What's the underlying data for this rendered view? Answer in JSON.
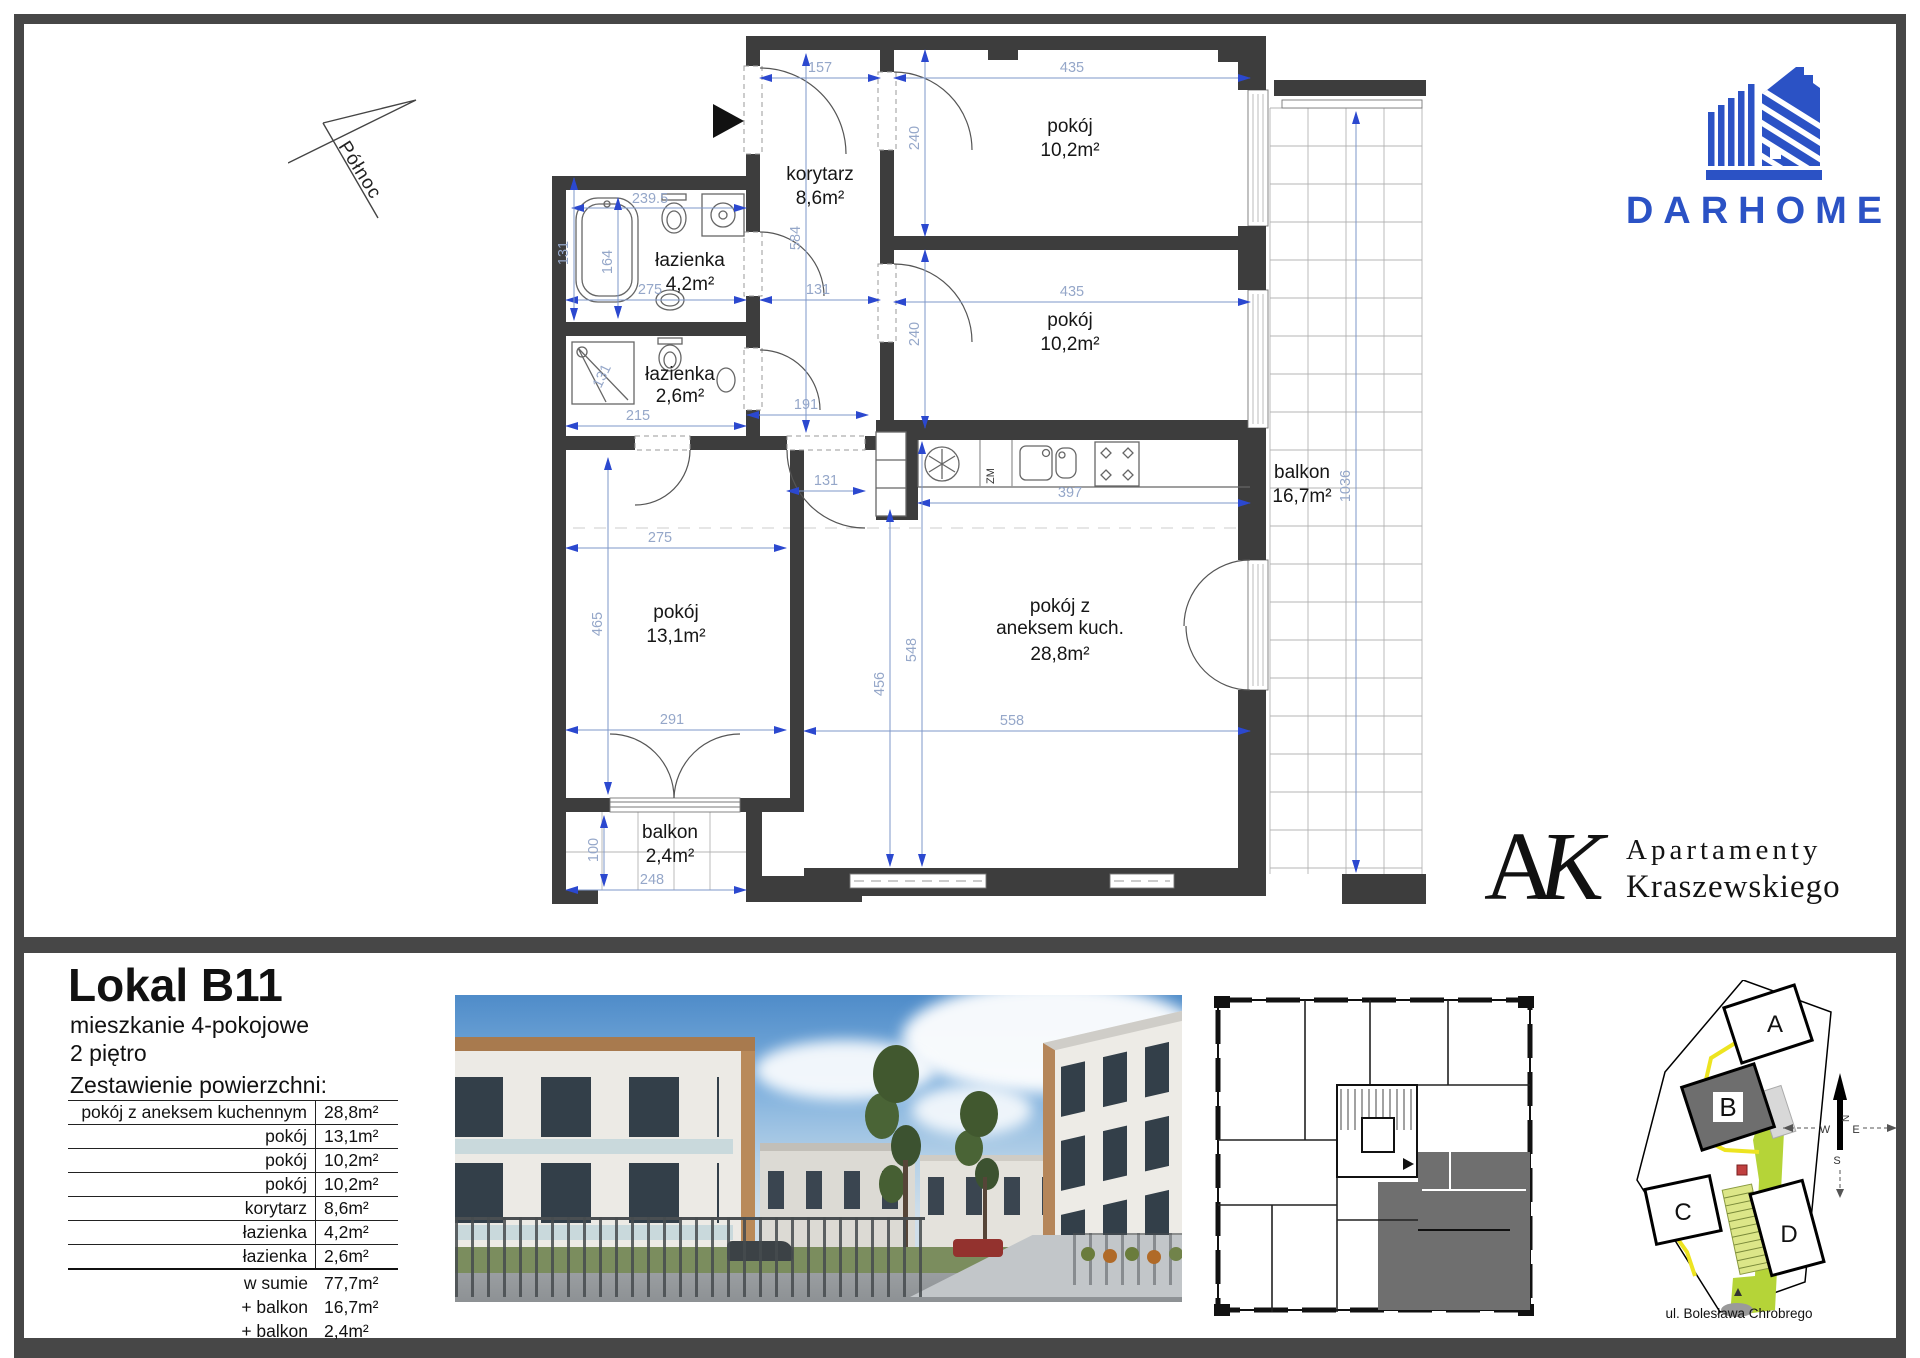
{
  "plan": {
    "north_label": "Północ",
    "rooms": {
      "korytarz": {
        "name": "korytarz",
        "area": "8,6m²"
      },
      "lazienka_duza": {
        "name": "łazienka",
        "area": "4,2m²"
      },
      "lazienka_mala": {
        "name": "łazienka",
        "area": "2,6m²"
      },
      "pokoj_gorny": {
        "name": "pokój",
        "area": "10,2m²"
      },
      "pokoj_srodkowy": {
        "name": "pokój",
        "area": "10,2m²"
      },
      "pokoj_duzy": {
        "name": "pokój",
        "area": "13,1m²"
      },
      "salon": {
        "line1": "pokój z",
        "line2": "aneksem kuch.",
        "area": "28,8m²"
      },
      "balkon_duzy": {
        "name": "balkon",
        "area": "16,7m²"
      },
      "balkon_maly": {
        "name": "balkon",
        "area": "2,4m²"
      }
    },
    "labels": {
      "zm": "ZM"
    },
    "dims": {
      "d157": "157",
      "d435a": "435",
      "d435b": "435",
      "d240a": "240",
      "d240b": "240",
      "d2395": "239.5",
      "d164": "164",
      "d131a": "131",
      "d131b": "131",
      "d131c": "131",
      "d131d": "131",
      "d584": "584",
      "d275a": "275",
      "d275b": "275",
      "d215": "215",
      "d191": "191",
      "d397": "397",
      "d465": "465",
      "d548": "548",
      "d456": "456",
      "d291": "291",
      "d558": "558",
      "d100": "100",
      "d248": "248",
      "d1036": "1036"
    }
  },
  "branding": {
    "darhome": {
      "name": "DARHOME",
      "color": "#2b52c5"
    },
    "ak": {
      "a": "A",
      "k": "K",
      "line1": "Apartamenty",
      "line2": "Kraszewskiego"
    }
  },
  "details": {
    "title": "Lokal B11",
    "subtitle1": "mieszkanie 4-pokojowe",
    "subtitle2": "2 piętro",
    "table_title": "Zestawienie powierzchni:",
    "rows": [
      {
        "label": "pokój z aneksem kuchennym",
        "value": "28,8m²"
      },
      {
        "label": "pokój",
        "value": "13,1m²"
      },
      {
        "label": "pokój",
        "value": "10,2m²"
      },
      {
        "label": "pokój",
        "value": "10,2m²"
      },
      {
        "label": "korytarz",
        "value": "8,6m²"
      },
      {
        "label": "łazienka",
        "value": "4,2m²"
      },
      {
        "label": "łazienka",
        "value": "2,6m²"
      }
    ],
    "summary": [
      {
        "label": "w sumie",
        "value": "77,7m²"
      },
      {
        "label": "+ balkon",
        "value": "16,7m²"
      },
      {
        "label": "+ balkon",
        "value": "2,4m²"
      }
    ]
  },
  "siteplan": {
    "buildings": {
      "a": "A",
      "b": "B",
      "c": "C",
      "d": "D"
    },
    "street": "ul. Bolesława Chrobrego",
    "compass": {
      "n": "N",
      "w": "W",
      "e": "E",
      "s": "S"
    }
  }
}
